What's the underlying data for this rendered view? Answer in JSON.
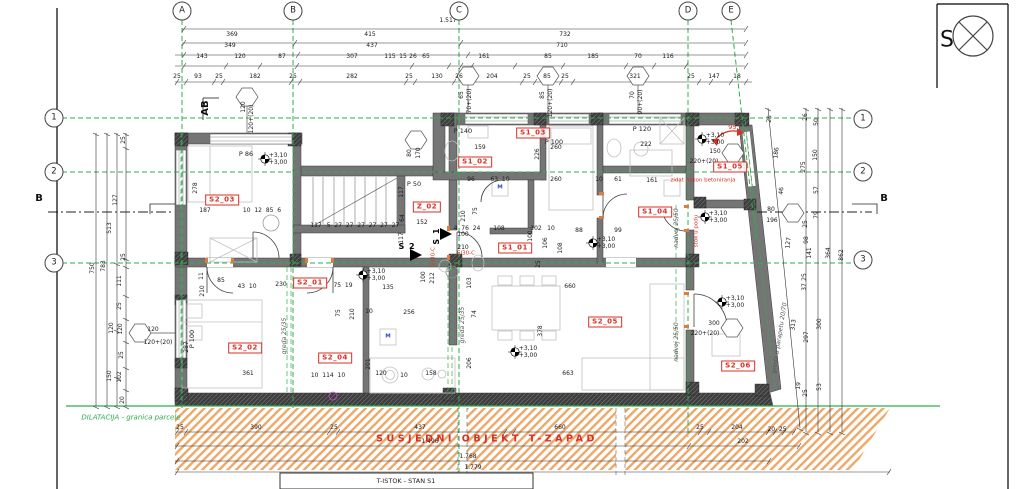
{
  "compass_label": "S",
  "banner": "SUSJEDNI OBJEKT T-ZAPAD",
  "title_box": "T-ISTOK - STAN S1",
  "colors": {
    "green": "#2fae4e",
    "red": "#d93025",
    "hatch_orange": "#eda868",
    "wall_gray": "#757575",
    "dark": "#3e3e3e"
  },
  "bubbles": [
    {
      "t": "A",
      "x": 182,
      "y": 11
    },
    {
      "t": "B",
      "x": 293,
      "y": 11
    },
    {
      "t": "C",
      "x": 459,
      "y": 11
    },
    {
      "t": "D",
      "x": 688,
      "y": 11
    },
    {
      "t": "E",
      "x": 731,
      "y": 11
    },
    {
      "t": "1",
      "x": 54,
      "y": 118
    },
    {
      "t": "2",
      "x": 54,
      "y": 172
    },
    {
      "t": "3",
      "x": 54,
      "y": 263
    },
    {
      "t": "1",
      "x": 863,
      "y": 119
    },
    {
      "t": "2",
      "x": 863,
      "y": 172
    },
    {
      "t": "3",
      "x": 863,
      "y": 260
    }
  ],
  "marks": [
    {
      "t": "B",
      "x": 39,
      "y": 199
    },
    {
      "t": "B",
      "x": 884,
      "y": 199
    },
    {
      "t": "AB",
      "x": 206,
      "y": 108,
      "r": -90
    }
  ],
  "entrances": [
    {
      "t": "S 2",
      "x": 407,
      "y": 247
    },
    {
      "t": "S 1",
      "x": 437,
      "y": 236,
      "r": -90
    }
  ],
  "rooms": [
    {
      "t": "S2_03",
      "x": 222,
      "y": 200
    },
    {
      "t": "Z_02",
      "x": 427,
      "y": 207
    },
    {
      "t": "S2_01",
      "x": 310,
      "y": 283
    },
    {
      "t": "S2_02",
      "x": 245,
      "y": 348
    },
    {
      "t": "S2_04",
      "x": 335,
      "y": 358
    },
    {
      "t": "S2_05",
      "x": 605,
      "y": 322
    },
    {
      "t": "S2_06",
      "x": 738,
      "y": 366
    },
    {
      "t": "S1_02",
      "x": 475,
      "y": 162
    },
    {
      "t": "S1_03",
      "x": 533,
      "y": 133
    },
    {
      "t": "S1_01",
      "x": 515,
      "y": 248
    },
    {
      "t": "S1_04",
      "x": 655,
      "y": 212
    },
    {
      "t": "S1_05",
      "x": 730,
      "y": 167
    }
  ],
  "tags": [
    {
      "t": "P 86",
      "x": 246,
      "y": 154
    },
    {
      "t": "P 140",
      "x": 463,
      "y": 131
    },
    {
      "t": "P 100",
      "x": 554,
      "y": 142
    },
    {
      "t": "P 120",
      "x": 642,
      "y": 129
    },
    {
      "t": "P 50",
      "x": 414,
      "y": 184
    },
    {
      "t": "P 100",
      "x": 192,
      "y": 339,
      "r": -90
    }
  ],
  "reds": [
    {
      "t": "zidat nakon betoniranja",
      "x": 703,
      "y": 181
    },
    {
      "t": "EI30-C",
      "x": 434,
      "y": 256,
      "r": -90
    },
    {
      "t": "EI30-C",
      "x": 466,
      "y": 254
    },
    {
      "t": "štok u podu",
      "x": 697,
      "y": 231,
      "r": -90
    }
  ],
  "degs": [
    {
      "t": "95°",
      "x": 734,
      "y": 127
    }
  ],
  "greens": [
    {
      "t": "DILATACIJA - granica parcele",
      "x": 131,
      "y": 418
    }
  ],
  "grays": [
    {
      "t": "greda 25/35",
      "x": 285,
      "y": 336,
      "r": -90
    },
    {
      "t": "greda 25/35",
      "x": 463,
      "y": 325,
      "r": -90
    },
    {
      "t": "nadvoj 25/50",
      "x": 677,
      "y": 228,
      "r": -90
    },
    {
      "t": "nadvoj 25/50",
      "x": 677,
      "y": 342,
      "r": -90
    },
    {
      "t": "greda u parapetu 20/70",
      "x": 780,
      "y": 338,
      "r": -81
    }
  ],
  "blues": [
    {
      "t": "M",
      "x": 500,
      "y": 188
    },
    {
      "t": "M",
      "x": 388,
      "y": 337
    }
  ],
  "dims": [
    {
      "t": "1.517",
      "x": 448,
      "y": 21
    },
    {
      "t": "369",
      "x": 232,
      "y": 35
    },
    {
      "t": "415",
      "x": 370,
      "y": 35
    },
    {
      "t": "732",
      "x": 565,
      "y": 35
    },
    {
      "t": "349",
      "x": 230,
      "y": 46
    },
    {
      "t": "437",
      "x": 372,
      "y": 46
    },
    {
      "t": "710",
      "x": 562,
      "y": 46
    },
    {
      "t": "143",
      "x": 202,
      "y": 57
    },
    {
      "t": "120",
      "x": 240,
      "y": 57
    },
    {
      "t": "87",
      "x": 282,
      "y": 57
    },
    {
      "t": "307",
      "x": 352,
      "y": 57
    },
    {
      "t": "115",
      "x": 390,
      "y": 57
    },
    {
      "t": "15",
      "x": 403,
      "y": 57
    },
    {
      "t": "26",
      "x": 413,
      "y": 57
    },
    {
      "t": "65",
      "x": 426,
      "y": 57
    },
    {
      "t": "161",
      "x": 484,
      "y": 57
    },
    {
      "t": "85",
      "x": 548,
      "y": 57
    },
    {
      "t": "185",
      "x": 593,
      "y": 57
    },
    {
      "t": "70",
      "x": 638,
      "y": 57
    },
    {
      "t": "116",
      "x": 668,
      "y": 57
    },
    {
      "t": "25",
      "x": 177,
      "y": 77
    },
    {
      "t": "93",
      "x": 198,
      "y": 77
    },
    {
      "t": "25",
      "x": 219,
      "y": 77
    },
    {
      "t": "182",
      "x": 255,
      "y": 77
    },
    {
      "t": "25",
      "x": 293,
      "y": 77
    },
    {
      "t": "282",
      "x": 352,
      "y": 77
    },
    {
      "t": "25",
      "x": 409,
      "y": 77
    },
    {
      "t": "130",
      "x": 437,
      "y": 77
    },
    {
      "t": "26",
      "x": 459,
      "y": 77
    },
    {
      "t": "204",
      "x": 492,
      "y": 77
    },
    {
      "t": "25",
      "x": 527,
      "y": 77
    },
    {
      "t": "85",
      "x": 547,
      "y": 77
    },
    {
      "t": "25",
      "x": 565,
      "y": 77
    },
    {
      "t": "321",
      "x": 635,
      "y": 77
    },
    {
      "t": "25",
      "x": 691,
      "y": 77
    },
    {
      "t": "147",
      "x": 714,
      "y": 77
    },
    {
      "t": "18",
      "x": 737,
      "y": 77
    },
    {
      "t": "25",
      "x": 124,
      "y": 140,
      "r": -90
    },
    {
      "t": "127",
      "x": 116,
      "y": 200,
      "r": -90
    },
    {
      "t": "513",
      "x": 110,
      "y": 228,
      "r": -90
    },
    {
      "t": "25",
      "x": 124,
      "y": 257,
      "r": -90
    },
    {
      "t": "111",
      "x": 120,
      "y": 281,
      "r": -90
    },
    {
      "t": "25",
      "x": 120,
      "y": 306,
      "r": -90
    },
    {
      "t": "120",
      "x": 112,
      "y": 328,
      "r": -90
    },
    {
      "t": "120",
      "x": 121,
      "y": 329,
      "r": -90
    },
    {
      "t": "25",
      "x": 122,
      "y": 355,
      "r": -90
    },
    {
      "t": "150",
      "x": 110,
      "y": 376,
      "r": -90
    },
    {
      "t": "102",
      "x": 120,
      "y": 377,
      "r": -90
    },
    {
      "t": "20",
      "x": 123,
      "y": 400,
      "r": -90
    },
    {
      "t": "750",
      "x": 93,
      "y": 268,
      "r": -90
    },
    {
      "t": "783",
      "x": 104,
      "y": 266,
      "r": -90
    },
    {
      "t": "287",
      "x": 187,
      "y": 347,
      "r": -90
    },
    {
      "t": "120",
      "x": 153,
      "y": 330
    },
    {
      "t": "120+(20)",
      "x": 158,
      "y": 343
    },
    {
      "t": "278",
      "x": 196,
      "y": 188,
      "r": -90
    },
    {
      "t": "187",
      "x": 205,
      "y": 211
    },
    {
      "t": "10  12  85  6",
      "x": 262,
      "y": 211
    },
    {
      "t": "117",
      "x": 316,
      "y": 226
    },
    {
      "t": "5  27  27  27  27  27  27",
      "x": 363,
      "y": 226
    },
    {
      "t": "11",
      "x": 202,
      "y": 276,
      "r": -90
    },
    {
      "t": "85",
      "x": 221,
      "y": 281
    },
    {
      "t": "43  10",
      "x": 247,
      "y": 287
    },
    {
      "t": "230",
      "x": 281,
      "y": 285
    },
    {
      "t": "75  19",
      "x": 343,
      "y": 286
    },
    {
      "t": "135",
      "x": 388,
      "y": 288
    },
    {
      "t": "210",
      "x": 203,
      "y": 291,
      "r": -90
    },
    {
      "t": "75",
      "x": 339,
      "y": 313,
      "r": -90
    },
    {
      "t": "210",
      "x": 353,
      "y": 314,
      "r": -90
    },
    {
      "t": "10",
      "x": 369,
      "y": 312
    },
    {
      "t": "256",
      "x": 409,
      "y": 313
    },
    {
      "t": "361",
      "x": 248,
      "y": 374
    },
    {
      "t": "10  114  10",
      "x": 328,
      "y": 376
    },
    {
      "t": "120",
      "x": 381,
      "y": 374
    },
    {
      "t": "10",
      "x": 404,
      "y": 376
    },
    {
      "t": "201",
      "x": 369,
      "y": 364,
      "r": -90
    },
    {
      "t": "158",
      "x": 431,
      "y": 374
    },
    {
      "t": "103",
      "x": 470,
      "y": 283,
      "r": -90
    },
    {
      "t": "660",
      "x": 570,
      "y": 287
    },
    {
      "t": "74",
      "x": 475,
      "y": 314,
      "r": -90
    },
    {
      "t": "378",
      "x": 541,
      "y": 331,
      "r": -90
    },
    {
      "t": "206",
      "x": 470,
      "y": 363,
      "r": -90
    },
    {
      "t": "663",
      "x": 568,
      "y": 374
    },
    {
      "t": "212",
      "x": 433,
      "y": 278,
      "r": -90
    },
    {
      "t": "100",
      "x": 424,
      "y": 277,
      "r": -90
    },
    {
      "t": "159",
      "x": 480,
      "y": 148
    },
    {
      "t": "96",
      "x": 471,
      "y": 180
    },
    {
      "t": "63  10",
      "x": 500,
      "y": 180
    },
    {
      "t": "226",
      "x": 538,
      "y": 154,
      "r": -90
    },
    {
      "t": "260",
      "x": 556,
      "y": 180
    },
    {
      "t": "260",
      "x": 556,
      "y": 148
    },
    {
      "t": "10",
      "x": 599,
      "y": 180
    },
    {
      "t": "61",
      "x": 618,
      "y": 180
    },
    {
      "t": "222",
      "x": 646,
      "y": 145
    },
    {
      "t": "161",
      "x": 652,
      "y": 181
    },
    {
      "t": "210",
      "x": 464,
      "y": 216,
      "r": -90
    },
    {
      "t": "75",
      "x": 476,
      "y": 211,
      "r": -90
    },
    {
      "t": "4  76  24",
      "x": 467,
      "y": 229
    },
    {
      "t": "100",
      "x": 463,
      "y": 235
    },
    {
      "t": "210",
      "x": 463,
      "y": 248
    },
    {
      "t": "108",
      "x": 499,
      "y": 229
    },
    {
      "t": "102",
      "x": 536,
      "y": 229
    },
    {
      "t": "100",
      "x": 531,
      "y": 236,
      "r": -90
    },
    {
      "t": "10",
      "x": 551,
      "y": 229
    },
    {
      "t": "108",
      "x": 561,
      "y": 248,
      "r": -90
    },
    {
      "t": "25",
      "x": 539,
      "y": 264,
      "r": -90
    },
    {
      "t": "88",
      "x": 579,
      "y": 231
    },
    {
      "t": "99",
      "x": 618,
      "y": 231
    },
    {
      "t": "106",
      "x": 546,
      "y": 243,
      "r": -90
    },
    {
      "t": "117",
      "x": 402,
      "y": 192,
      "r": -90
    },
    {
      "t": "64",
      "x": 403,
      "y": 218,
      "r": -90
    },
    {
      "t": "152",
      "x": 422,
      "y": 223
    },
    {
      "t": "117",
      "x": 402,
      "y": 238,
      "r": -90
    },
    {
      "t": "80",
      "x": 410,
      "y": 153,
      "r": -90
    },
    {
      "t": "170",
      "x": 419,
      "y": 153,
      "r": -90
    },
    {
      "t": "80",
      "x": 771,
      "y": 210
    },
    {
      "t": "196",
      "x": 772,
      "y": 221
    },
    {
      "t": "150",
      "x": 715,
      "y": 152
    },
    {
      "t": "220+(20)",
      "x": 704,
      "y": 162
    },
    {
      "t": "300",
      "x": 714,
      "y": 324
    },
    {
      "t": "220+(20)",
      "x": 705,
      "y": 334
    },
    {
      "t": "120",
      "x": 244,
      "y": 107,
      "r": -90
    },
    {
      "t": "120+(20)",
      "x": 252,
      "y": 119,
      "r": -90
    },
    {
      "t": "65",
      "x": 462,
      "y": 95,
      "r": -90
    },
    {
      "t": "70+(20)",
      "x": 470,
      "y": 101,
      "r": -90
    },
    {
      "t": "85",
      "x": 543,
      "y": 95,
      "r": -90
    },
    {
      "t": "120+(20)",
      "x": 551,
      "y": 103,
      "r": -90
    },
    {
      "t": "70",
      "x": 633,
      "y": 95,
      "r": -90
    },
    {
      "t": "90+(20)",
      "x": 641,
      "y": 102,
      "r": -90
    },
    {
      "t": "+3,10",
      "x": 278,
      "y": 156
    },
    {
      "t": "+3,00",
      "x": 278,
      "y": 163
    },
    {
      "t": "+3,10",
      "x": 376,
      "y": 272
    },
    {
      "t": "+3,00",
      "x": 376,
      "y": 279
    },
    {
      "t": "+3,10",
      "x": 528,
      "y": 349
    },
    {
      "t": "+3,00",
      "x": 528,
      "y": 356
    },
    {
      "t": "+3,10",
      "x": 606,
      "y": 240
    },
    {
      "t": "+3,00",
      "x": 606,
      "y": 247
    },
    {
      "t": "+3,10",
      "x": 715,
      "y": 136
    },
    {
      "t": "+3,00",
      "x": 715,
      "y": 143
    },
    {
      "t": "+3,10",
      "x": 718,
      "y": 214
    },
    {
      "t": "+3,00",
      "x": 718,
      "y": 221
    },
    {
      "t": "+3,10",
      "x": 735,
      "y": 299
    },
    {
      "t": "+3,00",
      "x": 735,
      "y": 306
    },
    {
      "t": "25",
      "x": 770,
      "y": 119,
      "r": -84
    },
    {
      "t": "186",
      "x": 777,
      "y": 153,
      "r": -84
    },
    {
      "t": "46",
      "x": 782,
      "y": 191,
      "r": -84
    },
    {
      "t": "127",
      "x": 789,
      "y": 243,
      "r": -84
    },
    {
      "t": "313",
      "x": 794,
      "y": 325,
      "r": -84
    },
    {
      "t": "19",
      "x": 799,
      "y": 386,
      "r": -84
    },
    {
      "t": "26",
      "x": 806,
      "y": 117,
      "r": -90
    },
    {
      "t": "275",
      "x": 804,
      "y": 167,
      "r": -90
    },
    {
      "t": "25",
      "x": 806,
      "y": 224,
      "r": -90
    },
    {
      "t": "98",
      "x": 807,
      "y": 240,
      "r": -90
    },
    {
      "t": "141",
      "x": 810,
      "y": 253,
      "r": -90
    },
    {
      "t": "25",
      "x": 805,
      "y": 277,
      "r": -90
    },
    {
      "t": "37",
      "x": 805,
      "y": 287,
      "r": -90
    },
    {
      "t": "297",
      "x": 807,
      "y": 337,
      "r": -90
    },
    {
      "t": "25",
      "x": 806,
      "y": 393,
      "r": -90
    },
    {
      "t": "50",
      "x": 817,
      "y": 122,
      "r": -90
    },
    {
      "t": "150",
      "x": 816,
      "y": 155,
      "r": -90
    },
    {
      "t": "57",
      "x": 817,
      "y": 190,
      "r": -90
    },
    {
      "t": "79",
      "x": 817,
      "y": 215,
      "r": -90
    },
    {
      "t": "300",
      "x": 820,
      "y": 324,
      "r": -90
    },
    {
      "t": "53",
      "x": 820,
      "y": 387,
      "r": -90
    },
    {
      "t": "364",
      "x": 829,
      "y": 253,
      "r": -90
    },
    {
      "t": "862",
      "x": 842,
      "y": 255,
      "r": -90
    },
    {
      "t": "20  25",
      "x": 777,
      "y": 430
    },
    {
      "t": "25",
      "x": 180,
      "y": 428
    },
    {
      "t": "390",
      "x": 256,
      "y": 428
    },
    {
      "t": "25",
      "x": 334,
      "y": 428
    },
    {
      "t": "437",
      "x": 420,
      "y": 428
    },
    {
      "t": "660",
      "x": 560,
      "y": 428
    },
    {
      "t": "25",
      "x": 700,
      "y": 428
    },
    {
      "t": "204",
      "x": 737,
      "y": 428
    },
    {
      "t": "1.496",
      "x": 430,
      "y": 442
    },
    {
      "t": "202",
      "x": 743,
      "y": 442
    },
    {
      "t": "1.768",
      "x": 468,
      "y": 457
    },
    {
      "t": "1.779",
      "x": 473,
      "y": 468
    }
  ]
}
